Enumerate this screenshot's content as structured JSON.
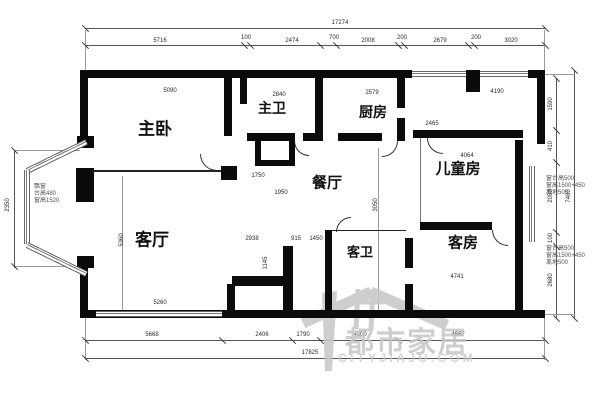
{
  "drawing": {
    "type": "apartment floor plan",
    "rooms": [
      {
        "id": "master-bedroom",
        "label": "主卧"
      },
      {
        "id": "master-bath",
        "label": "主卫"
      },
      {
        "id": "kitchen",
        "label": "厨房"
      },
      {
        "id": "dining-room",
        "label": "餐厅"
      },
      {
        "id": "kids-room",
        "label": "儿童房"
      },
      {
        "id": "living-room",
        "label": "客厅"
      },
      {
        "id": "guest-bath",
        "label": "客卫"
      },
      {
        "id": "guest-room",
        "label": "客房"
      }
    ],
    "dimensions": {
      "top_overall": "17274",
      "top_segments": [
        "5716",
        "100",
        "2474",
        "700",
        "2008",
        "200",
        "2679",
        "200",
        "3020"
      ],
      "bottom_segments": [
        "5668",
        "2406",
        "1790",
        "4500",
        "4667"
      ],
      "bottom_overall": "17825",
      "left_overall": "2350",
      "right_segments": [
        "1590",
        "410",
        "2050",
        "100",
        "2680"
      ],
      "right_overall": "7480"
    },
    "dim_labels": [
      {
        "t": "17274",
        "x": 340,
        "y": 23,
        "r": 0
      },
      {
        "t": "5716",
        "x": 160,
        "y": 41,
        "r": 0
      },
      {
        "t": "100",
        "x": 246,
        "y": 38,
        "r": 0
      },
      {
        "t": "2474",
        "x": 292,
        "y": 41,
        "r": 0
      },
      {
        "t": "700",
        "x": 334,
        "y": 38,
        "r": 0
      },
      {
        "t": "2008",
        "x": 368,
        "y": 41,
        "r": 0
      },
      {
        "t": "200",
        "x": 402,
        "y": 38,
        "r": 0
      },
      {
        "t": "2679",
        "x": 440,
        "y": 41,
        "r": 0
      },
      {
        "t": "200",
        "x": 476,
        "y": 38,
        "r": 0
      },
      {
        "t": "3020",
        "x": 511,
        "y": 41,
        "r": 0
      },
      {
        "t": "5668",
        "x": 152,
        "y": 335,
        "r": 0
      },
      {
        "t": "2406",
        "x": 262,
        "y": 335,
        "r": 0
      },
      {
        "t": "1790",
        "x": 303,
        "y": 335,
        "r": 0
      },
      {
        "t": "4500",
        "x": 360,
        "y": 335,
        "r": 0
      },
      {
        "t": "4667",
        "x": 458,
        "y": 335,
        "r": 0
      },
      {
        "t": "17825",
        "x": 310,
        "y": 353,
        "r": 0
      },
      {
        "t": "2350",
        "x": 8,
        "y": 205,
        "r": 1
      },
      {
        "t": "1590",
        "x": 551,
        "y": 104,
        "r": 1
      },
      {
        "t": "410",
        "x": 551,
        "y": 146,
        "r": 1
      },
      {
        "t": "2050",
        "x": 551,
        "y": 196,
        "r": 1
      },
      {
        "t": "100",
        "x": 551,
        "y": 238,
        "r": 1
      },
      {
        "t": "2680",
        "x": 551,
        "y": 280,
        "r": 1
      },
      {
        "t": "7480",
        "x": 569,
        "y": 196,
        "r": 1
      },
      {
        "t": "5090",
        "x": 170,
        "y": 91,
        "r": 0
      },
      {
        "t": "2840",
        "x": 279,
        "y": 95,
        "r": 0
      },
      {
        "t": "2579",
        "x": 372,
        "y": 93,
        "r": 0
      },
      {
        "t": "4190",
        "x": 497,
        "y": 92,
        "r": 0
      },
      {
        "t": "2465",
        "x": 432,
        "y": 124,
        "r": 0
      },
      {
        "t": "1750",
        "x": 258,
        "y": 176,
        "r": 0
      },
      {
        "t": "1950",
        "x": 281,
        "y": 193,
        "r": 0
      },
      {
        "t": "4064",
        "x": 467,
        "y": 156,
        "r": 0
      },
      {
        "t": "2938",
        "x": 252,
        "y": 239,
        "r": 0
      },
      {
        "t": "915",
        "x": 296,
        "y": 239,
        "r": 0
      },
      {
        "t": "1450",
        "x": 316,
        "y": 239,
        "r": 0
      },
      {
        "t": "1145",
        "x": 266,
        "y": 263,
        "r": 1
      },
      {
        "t": "5260",
        "x": 160,
        "y": 303,
        "r": 0
      },
      {
        "t": "4741",
        "x": 457,
        "y": 277,
        "r": 0
      },
      {
        "t": "5360",
        "x": 122,
        "y": 240,
        "r": 1
      },
      {
        "t": "3050",
        "x": 376,
        "y": 205,
        "r": 1
      }
    ],
    "annotations": [
      {
        "x": 34,
        "y": 184,
        "lines": [
          "飘窗",
          "台高480",
          "窗高1520"
        ]
      },
      {
        "x": 546,
        "y": 176,
        "lines": [
          "窗台高500",
          "窗高1500+450",
          "离地500"
        ]
      },
      {
        "x": 546,
        "y": 246,
        "lines": [
          "窗台高500",
          "窗高1500+450",
          "离地500"
        ]
      }
    ]
  },
  "watermark": {
    "brand": "都市家居",
    "site": "CITYJIAJU.COM"
  }
}
